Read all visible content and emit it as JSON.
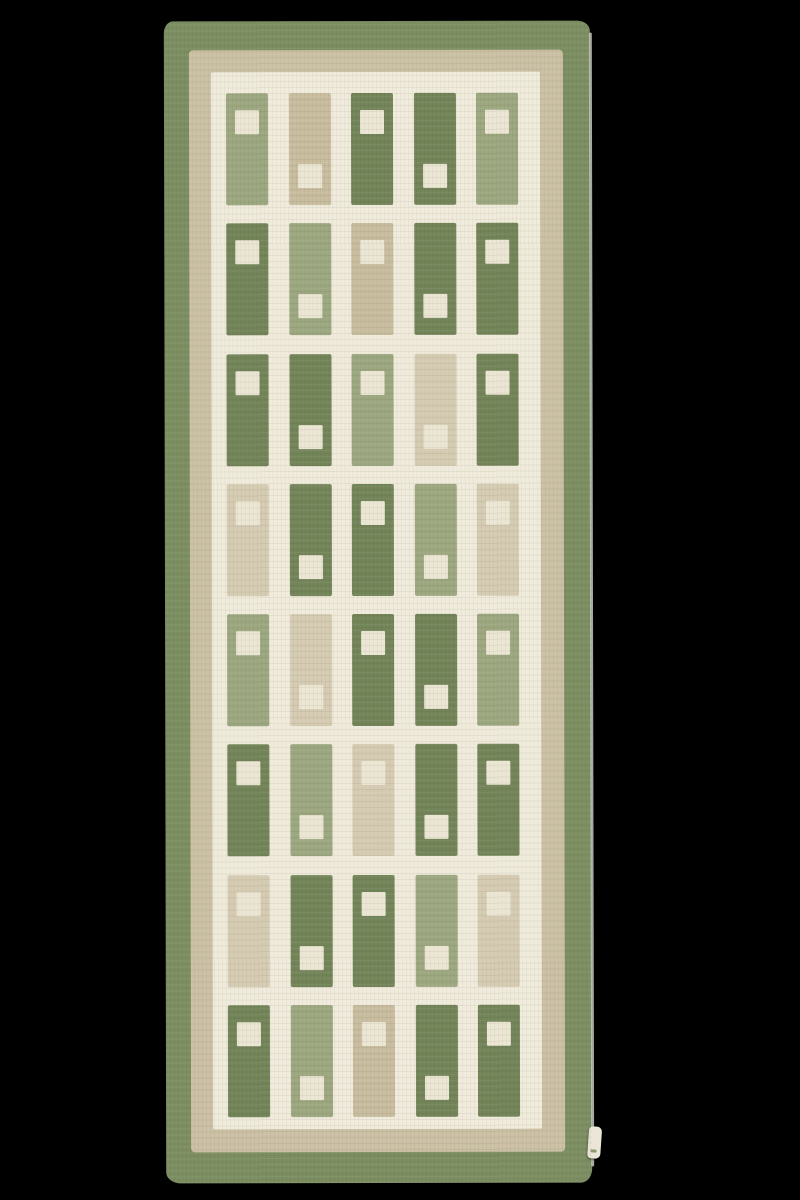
{
  "scene": {
    "description": "Photograph of a handwoven flat-weave wool runner rug, laid flat on a plain black background",
    "background_color": "#000000"
  },
  "rug": {
    "style": "Scandinavian flatweave runner with geometric block pattern",
    "palette": {
      "border_green": "#7d8f62",
      "band_beige": "#ccc1a5",
      "field_cream": "#f0ebdb",
      "cell_green": "#74855a",
      "cell_sage": "#9da881",
      "cell_tan": "#c9bda0",
      "cell_light_tan": "#d6ccb3",
      "inner_square": "#ece6d4",
      "selvedge": "#c2c8bc",
      "label_tag": "#ebe6d7"
    },
    "borders": {
      "outer": "olive green band",
      "middle": "beige band",
      "inner": "cream field"
    },
    "grid": {
      "columns": 5,
      "rows": 8,
      "square_position_by_column": [
        "top",
        "bottom",
        "top",
        "bottom",
        "top"
      ],
      "cells": [
        [
          "sage",
          "tan",
          "green",
          "green",
          "sage"
        ],
        [
          "green",
          "sage",
          "tan",
          "green",
          "green"
        ],
        [
          "green",
          "green",
          "sage",
          "light_tan",
          "green"
        ],
        [
          "light_tan",
          "green",
          "green",
          "sage",
          "light_tan"
        ],
        [
          "sage",
          "light_tan",
          "green",
          "green",
          "sage"
        ],
        [
          "green",
          "sage",
          "light_tan",
          "green",
          "green"
        ],
        [
          "light_tan",
          "green",
          "green",
          "sage",
          "light_tan"
        ],
        [
          "green",
          "sage",
          "tan",
          "green",
          "green"
        ]
      ]
    },
    "label_tag": {
      "present": true,
      "position": "lower right edge",
      "text": ""
    }
  }
}
